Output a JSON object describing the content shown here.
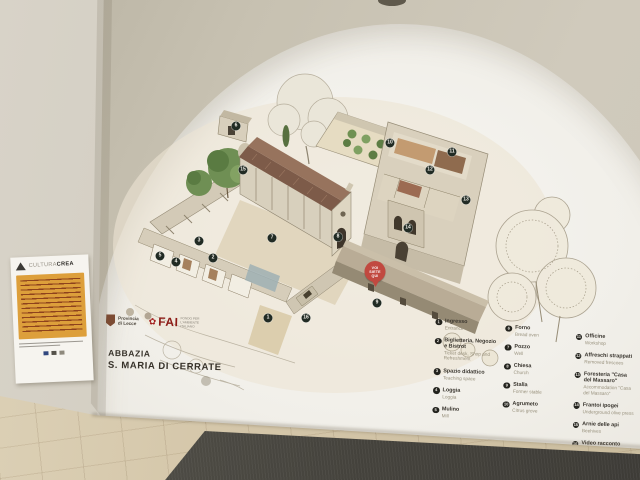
{
  "scene": {
    "description": "Photo of a museum wall with an arched niche containing an illustrated isometric map of the abbey complex",
    "title_lines": [
      "ABBAZIA",
      "S. MARIA DI CERRATE"
    ],
    "logos": {
      "provincia_line1": "Provincia",
      "provincia_line2": "di Lecce",
      "fai_flower": "✿",
      "fai": "FAI",
      "fai_sub": "Fondo per l'Ambiente Italiano"
    }
  },
  "poster": {
    "brand_light": "CULTURA",
    "brand_bold": "CREA"
  },
  "map": {
    "you_are_here": {
      "label": "VOI SIETE QUI",
      "x": 275,
      "y": 232
    },
    "markers": [
      {
        "n": 1,
        "x": 168,
        "y": 268
      },
      {
        "n": 2,
        "x": 113,
        "y": 208
      },
      {
        "n": 3,
        "x": 99,
        "y": 191
      },
      {
        "n": 4,
        "x": 76,
        "y": 212
      },
      {
        "n": 5,
        "x": 60,
        "y": 206
      },
      {
        "n": 6,
        "x": 136,
        "y": 76
      },
      {
        "n": 7,
        "x": 172,
        "y": 188
      },
      {
        "n": 8,
        "x": 238,
        "y": 187
      },
      {
        "n": 9,
        "x": 277,
        "y": 253
      },
      {
        "n": 10,
        "x": 290,
        "y": 93
      },
      {
        "n": 11,
        "x": 352,
        "y": 102
      },
      {
        "n": 12,
        "x": 330,
        "y": 120
      },
      {
        "n": 13,
        "x": 366,
        "y": 150
      },
      {
        "n": 14,
        "x": 308,
        "y": 178
      },
      {
        "n": 15,
        "x": 143,
        "y": 120
      },
      {
        "n": 16,
        "x": 206,
        "y": 268
      }
    ]
  },
  "legend": {
    "columns": [
      {
        "items": [
          {
            "num": 1,
            "it": "Ingresso",
            "en": "Entrance"
          },
          {
            "num": 2,
            "it": "Biglietteria, Negozio e Bistrot",
            "en": "Ticket desk, Shop and Refreshment"
          },
          {
            "num": 3,
            "it": "Spazio didattico",
            "en": "Teaching space"
          },
          {
            "num": 4,
            "it": "Loggia",
            "en": "Loggia"
          },
          {
            "num": 5,
            "it": "Mulino",
            "en": "Mill"
          }
        ]
      },
      {
        "items": [
          {
            "num": 6,
            "it": "Forno",
            "en": "Bread oven"
          },
          {
            "num": 7,
            "it": "Pozzo",
            "en": "Well"
          },
          {
            "num": 8,
            "it": "Chiesa",
            "en": "Church"
          },
          {
            "num": 9,
            "it": "Stalla",
            "en": "Former stable"
          },
          {
            "num": 10,
            "it": "Agrumeto",
            "en": "Citrus grove"
          }
        ]
      },
      {
        "items": [
          {
            "num": 11,
            "it": "Officine",
            "en": "Workshop"
          },
          {
            "num": 12,
            "it": "Affreschi strappati",
            "en": "Removed frescoes"
          },
          {
            "num": 13,
            "it": "Foresteria \"Casa del Massaro\"",
            "en": "Accommodation \"Casa del Massaro\""
          },
          {
            "num": 14,
            "it": "Frantoi ipogei",
            "en": "Underground olive press"
          },
          {
            "num": 15,
            "it": "Arnie delle api",
            "en": "Beehives"
          },
          {
            "num": 16,
            "it": "Video racconto sulla storia dell'Abbazia",
            "en": "Video story on the history of the Abbey"
          }
        ]
      }
    ]
  },
  "colors": {
    "outer_wall": "#c7c1b1",
    "arch_white": "#f2f0ea",
    "floor_tile": "#d5c7aa",
    "mat_gray": "#44423c",
    "marker_green": "#212b24",
    "pin_red": "#c14940",
    "fai_red": "#8d1b16",
    "poster_yellow": "#dd9f3b",
    "roof_brown": "#7d5b49",
    "tree_green": "#6f8f54"
  }
}
